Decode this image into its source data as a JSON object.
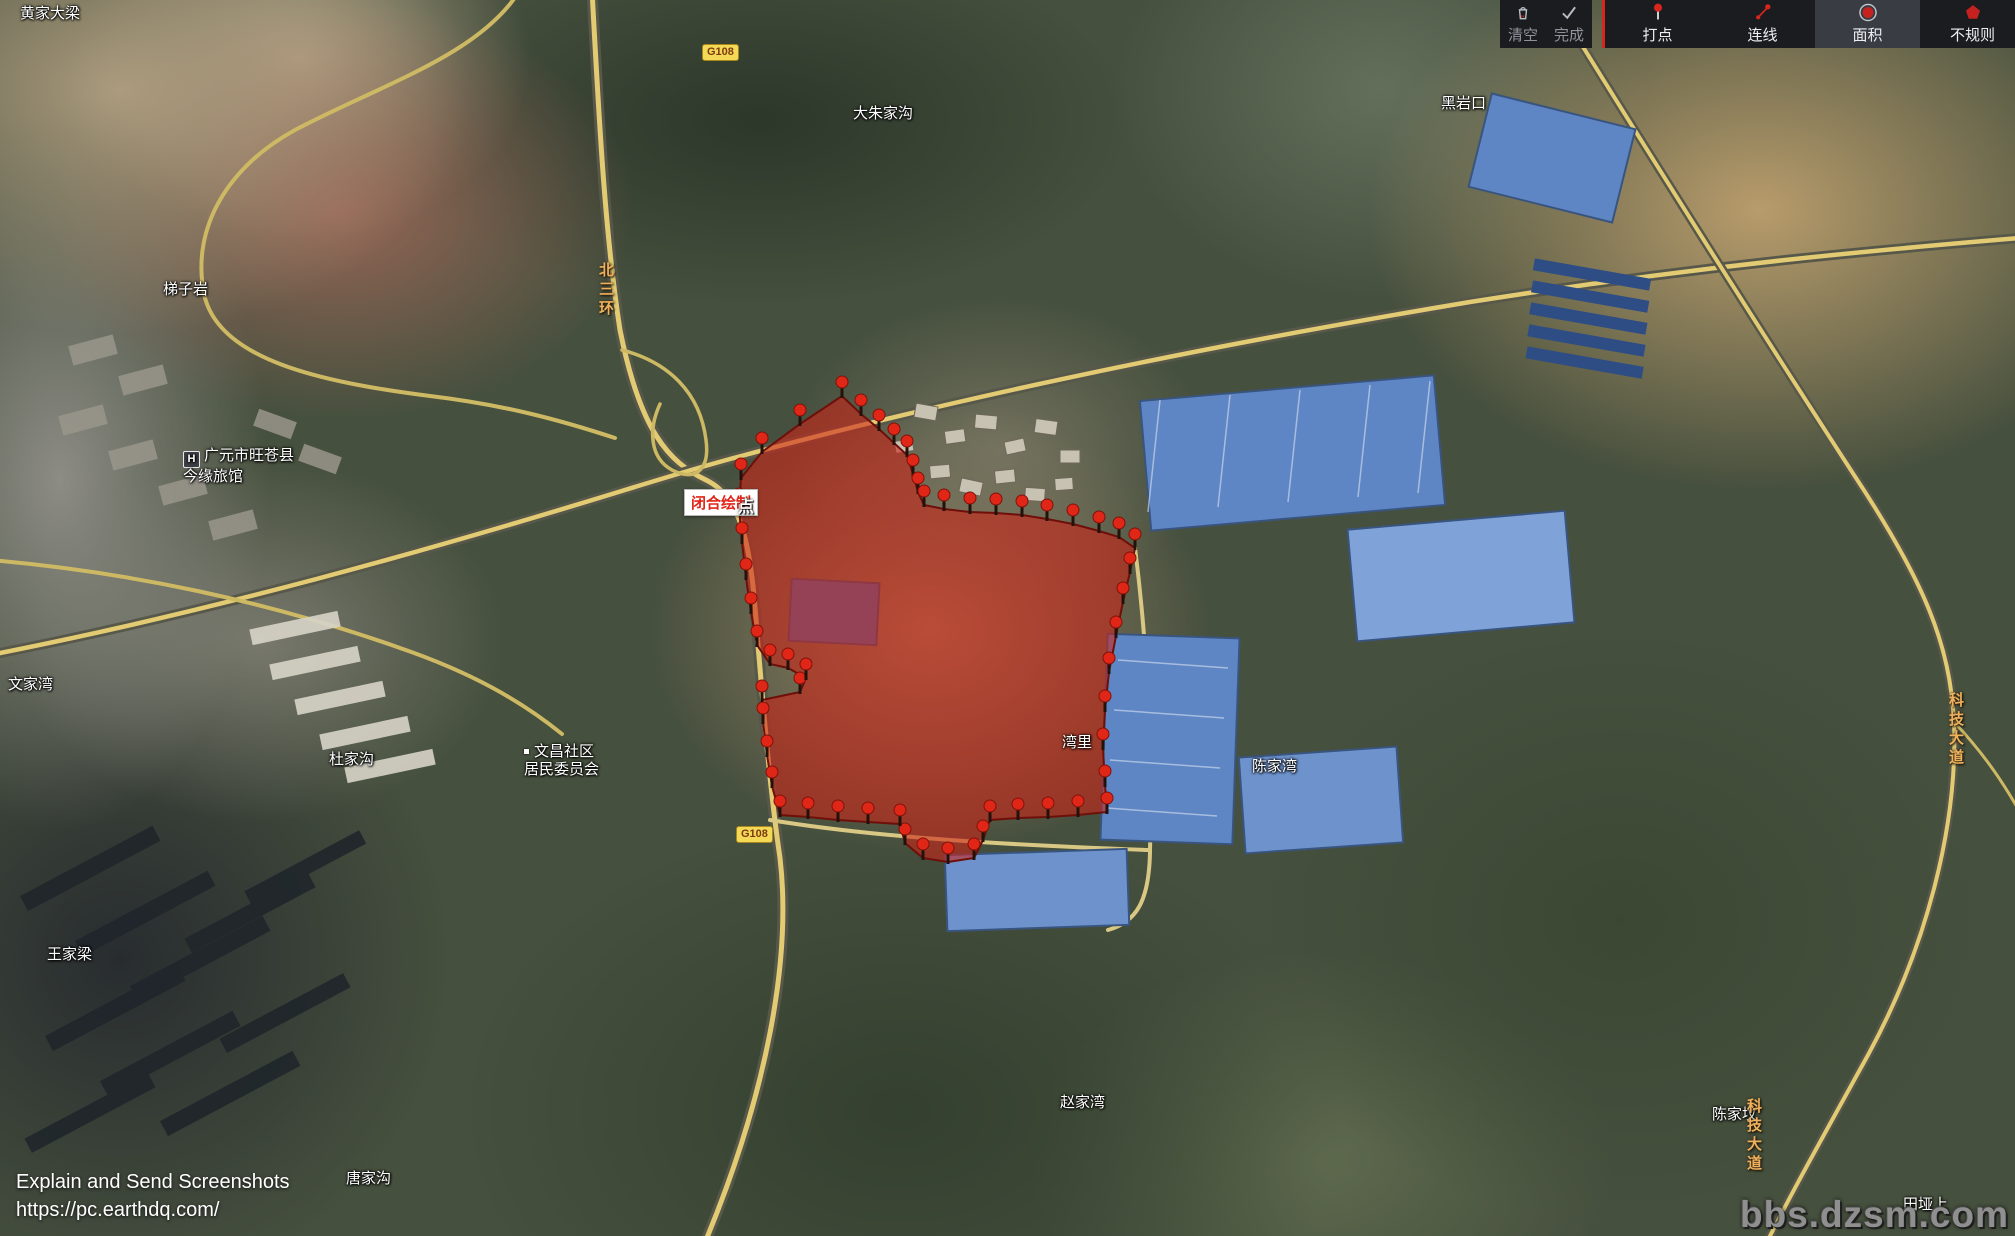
{
  "app": {
    "toolbar": {
      "clear": "清空",
      "done": "完成",
      "mark": "打点",
      "line": "连线",
      "area": "面积",
      "irregular": "不规则",
      "active_tool": "面积",
      "accent_color": "#d8261c"
    },
    "tooltip": {
      "text": "闭合绘制",
      "overlap": "点"
    },
    "footer": {
      "line1": "Explain and Send Screenshots",
      "line2": "https://pc.earthdq.com/",
      "watermark": "bbs.dzsm.com"
    }
  },
  "map": {
    "colors": {
      "pin": "#e02717",
      "pin_stroke": "#7e120a",
      "place_label": "#ffffff",
      "road_label": "#eeb05c"
    },
    "labels": [
      {
        "lines": [
          "黄家大梁"
        ],
        "x": 20,
        "y": 5,
        "type": "place"
      },
      {
        "lines": [
          "梯子岩"
        ],
        "x": 163,
        "y": 281,
        "type": "place"
      },
      {
        "lines": [
          "大朱家沟"
        ],
        "x": 853,
        "y": 105,
        "type": "place"
      },
      {
        "lines": [
          "黑岩口"
        ],
        "x": 1441,
        "y": 95,
        "type": "place"
      },
      {
        "lines": [
          "广元市旺苍县",
          "今缘旅馆"
        ],
        "x": 183,
        "y": 447,
        "type": "place",
        "icon": "hotel"
      },
      {
        "lines": [
          "文家湾"
        ],
        "x": 8,
        "y": 676,
        "type": "place"
      },
      {
        "lines": [
          "杜家沟"
        ],
        "x": 329,
        "y": 751,
        "type": "place"
      },
      {
        "lines": [
          "文昌社区",
          "居民委员会"
        ],
        "x": 524,
        "y": 743,
        "type": "place",
        "icon": "dot"
      },
      {
        "lines": [
          "王家梁"
        ],
        "x": 47,
        "y": 946,
        "type": "place"
      },
      {
        "lines": [
          "唐家沟"
        ],
        "x": 346,
        "y": 1170,
        "type": "place"
      },
      {
        "lines": [
          "赵家湾"
        ],
        "x": 1060,
        "y": 1094,
        "type": "place"
      },
      {
        "lines": [
          "湾里"
        ],
        "x": 1062,
        "y": 734,
        "type": "place"
      },
      {
        "lines": [
          "陈家湾"
        ],
        "x": 1252,
        "y": 758,
        "type": "place"
      },
      {
        "lines": [
          "陈家坟"
        ],
        "x": 1712,
        "y": 1106,
        "type": "place"
      },
      {
        "lines": [
          "田垭上"
        ],
        "x": 1903,
        "y": 1196,
        "type": "place"
      },
      {
        "lines": [
          "北三环"
        ],
        "x": 596,
        "y": 262,
        "type": "vroad"
      },
      {
        "lines": [
          "科技大道"
        ],
        "x": 1946,
        "y": 692,
        "type": "vroad"
      },
      {
        "lines": [
          "科技大道"
        ],
        "x": 1744,
        "y": 1098,
        "type": "vroad"
      },
      {
        "lines": [
          "G108"
        ],
        "x": 736,
        "y": 826,
        "type": "shield"
      },
      {
        "lines": [
          "G108"
        ],
        "x": 702,
        "y": 44,
        "type": "shield"
      }
    ],
    "polygon": {
      "fill": "#cd2317",
      "opacity": 0.58,
      "stroke": "#6e0f0a",
      "points": [
        [
          842,
          396
        ],
        [
          861,
          414
        ],
        [
          879,
          429
        ],
        [
          894,
          443
        ],
        [
          907,
          455
        ],
        [
          913,
          474
        ],
        [
          918,
          492
        ],
        [
          924,
          505
        ],
        [
          944,
          509
        ],
        [
          970,
          512
        ],
        [
          996,
          513
        ],
        [
          1022,
          515
        ],
        [
          1047,
          519
        ],
        [
          1073,
          524
        ],
        [
          1099,
          531
        ],
        [
          1119,
          537
        ],
        [
          1135,
          548
        ],
        [
          1130,
          572
        ],
        [
          1123,
          602
        ],
        [
          1116,
          636
        ],
        [
          1109,
          672
        ],
        [
          1105,
          710
        ],
        [
          1103,
          748
        ],
        [
          1105,
          785
        ],
        [
          1107,
          812
        ],
        [
          1078,
          815
        ],
        [
          1048,
          817
        ],
        [
          1018,
          818
        ],
        [
          990,
          820
        ],
        [
          983,
          840
        ],
        [
          974,
          858
        ],
        [
          948,
          862
        ],
        [
          923,
          858
        ],
        [
          905,
          843
        ],
        [
          900,
          824
        ],
        [
          868,
          822
        ],
        [
          838,
          820
        ],
        [
          808,
          817
        ],
        [
          780,
          815
        ],
        [
          772,
          786
        ],
        [
          767,
          755
        ],
        [
          763,
          722
        ],
        [
          762,
          700
        ],
        [
          800,
          692
        ],
        [
          806,
          678
        ],
        [
          788,
          668
        ],
        [
          770,
          664
        ],
        [
          757,
          645
        ],
        [
          751,
          612
        ],
        [
          746,
          578
        ],
        [
          742,
          542
        ],
        [
          739,
          508
        ],
        [
          741,
          478
        ],
        [
          762,
          452
        ],
        [
          800,
          424
        ]
      ]
    },
    "pins": [
      [
        842,
        396
      ],
      [
        861,
        414
      ],
      [
        879,
        429
      ],
      [
        894,
        443
      ],
      [
        907,
        455
      ],
      [
        913,
        474
      ],
      [
        918,
        492
      ],
      [
        924,
        505
      ],
      [
        944,
        509
      ],
      [
        970,
        512
      ],
      [
        996,
        513
      ],
      [
        1022,
        515
      ],
      [
        1047,
        519
      ],
      [
        1073,
        524
      ],
      [
        1099,
        531
      ],
      [
        1119,
        537
      ],
      [
        1135,
        548
      ],
      [
        1130,
        572
      ],
      [
        1123,
        602
      ],
      [
        1116,
        636
      ],
      [
        1109,
        672
      ],
      [
        1105,
        710
      ],
      [
        1103,
        748
      ],
      [
        1105,
        785
      ],
      [
        1107,
        812
      ],
      [
        1078,
        815
      ],
      [
        1048,
        817
      ],
      [
        1018,
        818
      ],
      [
        990,
        820
      ],
      [
        983,
        840
      ],
      [
        974,
        858
      ],
      [
        948,
        862
      ],
      [
        923,
        858
      ],
      [
        905,
        843
      ],
      [
        900,
        824
      ],
      [
        868,
        822
      ],
      [
        838,
        820
      ],
      [
        808,
        817
      ],
      [
        780,
        815
      ],
      [
        772,
        786
      ],
      [
        767,
        755
      ],
      [
        763,
        722
      ],
      [
        762,
        700
      ],
      [
        800,
        692
      ],
      [
        806,
        678
      ],
      [
        788,
        668
      ],
      [
        770,
        664
      ],
      [
        757,
        645
      ],
      [
        751,
        612
      ],
      [
        746,
        578
      ],
      [
        742,
        542
      ],
      [
        739,
        508
      ],
      [
        741,
        478
      ],
      [
        762,
        452
      ],
      [
        800,
        424
      ]
    ]
  }
}
